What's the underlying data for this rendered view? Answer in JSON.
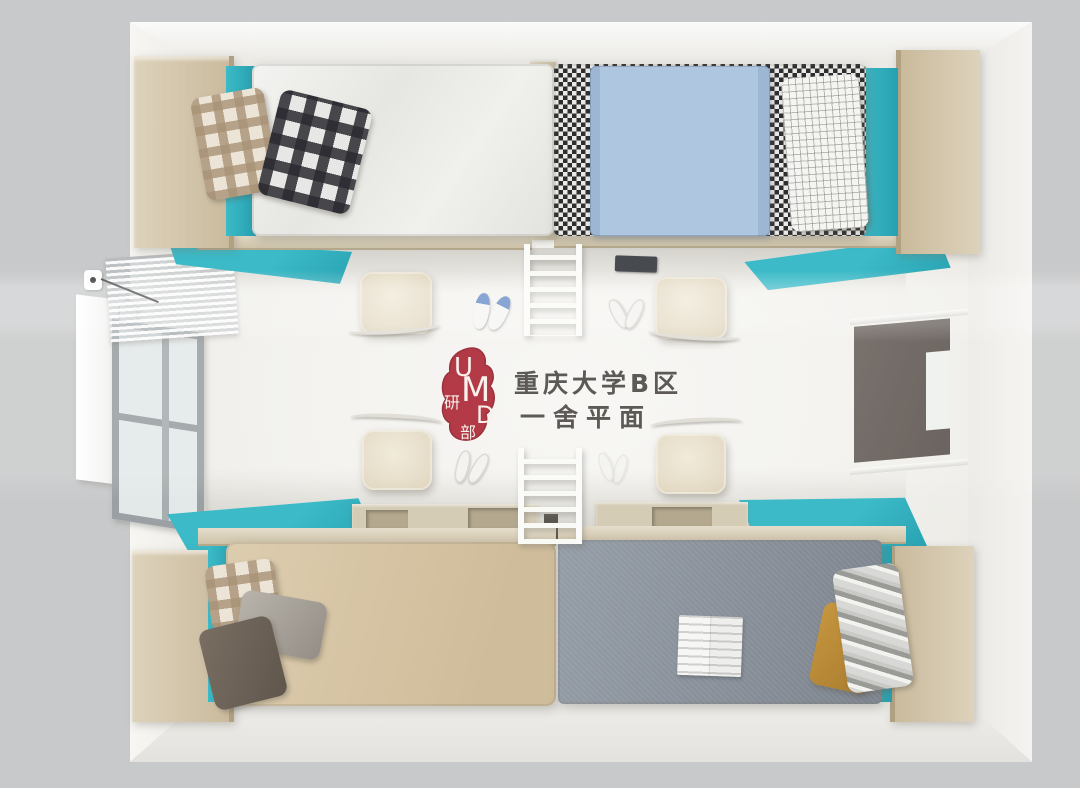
{
  "watermark": {
    "seal": {
      "letter_u": "U",
      "letter_m": "M",
      "letter_d": "D",
      "char_top": "研",
      "char_bottom": "部",
      "seal_color": "#a81f2c",
      "text_color": "#f7efe9"
    },
    "caption_line1": "重庆大学B区",
    "caption_line2": "一舍平面",
    "ink_color": "#45423f"
  },
  "scene": {
    "type": "top-down 3D render of a four-bed dormitory room",
    "objects": [
      "bed-top-left-white-bedding",
      "bed-top-right-houndstooth-with-blue-blanket",
      "bed-bottom-left-khaki-bedding",
      "bed-bottom-right-gray-bedding",
      "wardrobes-x4",
      "teal-cabinet-tops-x4",
      "desks-x4",
      "chairs-x4",
      "ladders-x2",
      "window-with-curtain-left-wall",
      "white-panel-left-wall",
      "power-outlet-with-cord",
      "dark-door-opening-right-wall",
      "sneakers-pair",
      "slippers-pairs-x3",
      "laptop",
      "open-magazine-on-gray-bed",
      "pillows-plaid-grid-gray-taupe-mustard-silver"
    ]
  },
  "palette": {
    "border_gray": "#c8c9ca",
    "wall": "#f0efec",
    "floor": "#f2f1ed",
    "wood_beige": "#d3c5ab",
    "teal": "#3cbac7",
    "teal_dark": "#26a0b0",
    "white_bedding": "#ededeb",
    "blue_blanket": "#aac3dd",
    "khaki_bedding": "#d8c8ab",
    "gray_bedding": "#878e99",
    "mustard": "#c6963f",
    "seal_red": "#a81f2c",
    "ink": "#45423f"
  }
}
